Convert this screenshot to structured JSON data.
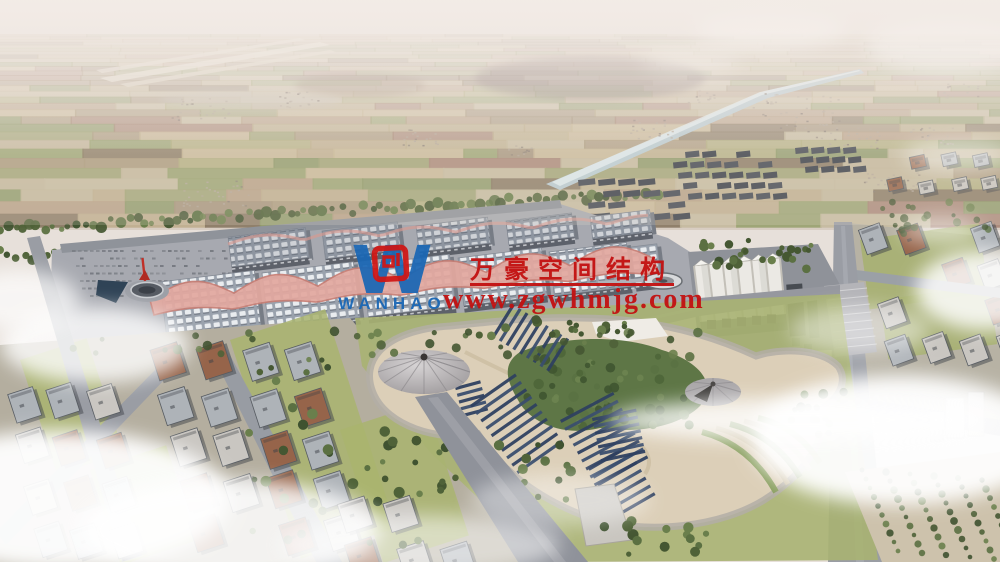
{
  "watermark": {
    "company_name_cn": "万豪空间结构",
    "website": "www.zgwhmjg.com",
    "logo_text": "WANHAO",
    "red": "#c31111",
    "logo_blue": "#1a67b5",
    "logo_red": "#d01513"
  }
}
